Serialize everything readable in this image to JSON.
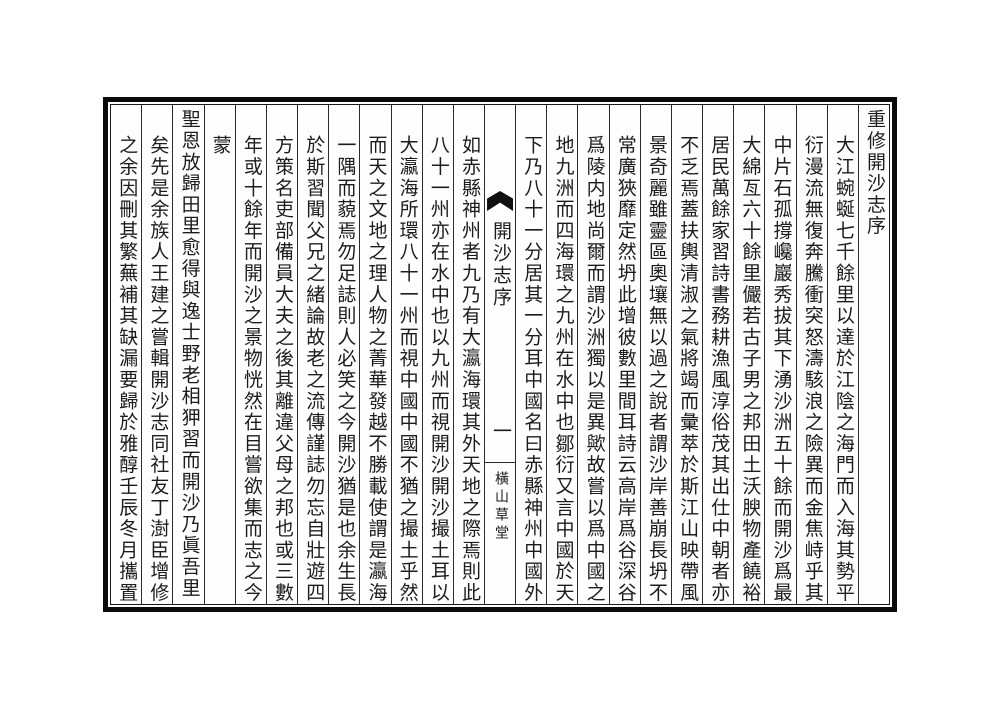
{
  "document": {
    "kind": "classical-chinese-book-page",
    "ink_color": "#1c1c1c",
    "frame_color": "#0b0b0b",
    "title": "重修開沙志序",
    "columns_right": [
      "大江蜿蜒七千餘里以達於江陰之海門而入海其勢平",
      "衍漫流無復奔騰衝突怒濤駭浪之險異而金焦峙乎其",
      "中片石孤撐巉巖秀拔其下湧沙洲五十餘而開沙爲最",
      "大綿亙六十餘里儼若古子男之邦田土沃腴物產饒裕",
      "居民萬餘家習詩書務耕漁風淳俗茂其出仕中朝者亦",
      "不乏焉蓋扶輿清淑之氣將竭而彙萃於斯江山映帶風",
      "景奇麗雖靈區奧壤無以過之說者謂沙岸善崩長坍不",
      "常廣狹靡定然坍此增彼數里間耳詩云高岸爲谷深谷",
      "爲陵内地尚爾而謂沙洲獨以是異歟故嘗以爲中國之",
      "地九洲而四海環之九州在水中也鄒衍又言中國於天",
      "下乃八十一分居其一分耳中國名曰赤縣神州中國外"
    ],
    "banxin": {
      "title": "開沙志序",
      "page_number": "一",
      "publisher": "橫山草堂",
      "fishtail_icon": "fishtail-mark"
    },
    "columns_left": [
      "如赤縣神州者九乃有大瀛海環其外天地之際焉則此",
      "八十一州亦在水中也以九州而視開沙開沙撮土耳以",
      "大瀛海所環八十一州而視中國中國不猶之撮土乎然",
      "而天之文地之理人物之菁華發越不勝載使謂是瀛海",
      "一隅而藐焉勿足誌則人必笑之今開沙猶是也余生長",
      "於斯習聞父兄之緒論故老之流傳謹誌勿忘自壯遊四",
      "方策名吏部備員大夫之後其離違父母之邦也或三數",
      "年或十餘年而開沙之景物恍然在目嘗欲集而志之今",
      "蒙",
      "聖恩放歸田里愈得與逸士野老相狎習而開沙乃眞吾里",
      "矣先是余族人王建之嘗輯開沙志同社友丁澍臣增修",
      "之余因刪其繁蕪補其缺漏要歸於雅醇壬辰冬月攜置"
    ]
  }
}
